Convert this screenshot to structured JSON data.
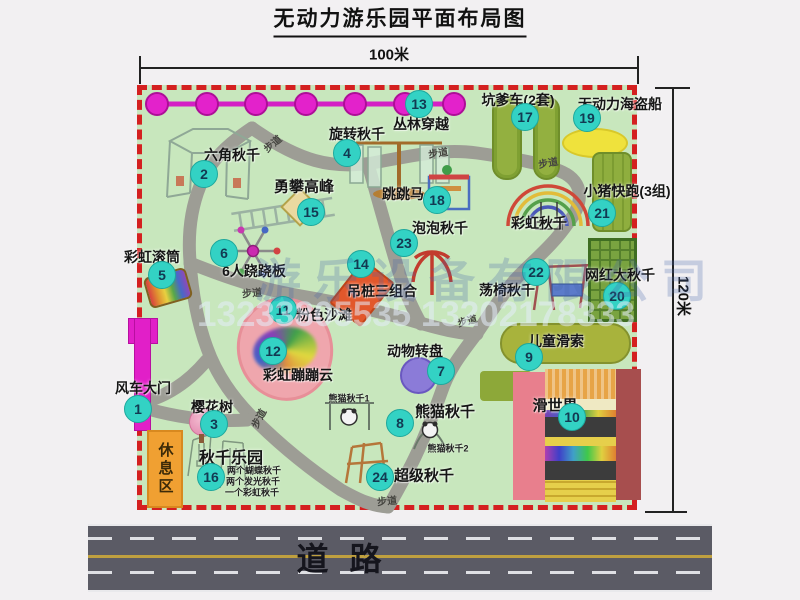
{
  "title": "无动力游乐园平面布局图",
  "dimensions": {
    "width": "100米",
    "height": "120米"
  },
  "watermark": {
    "company": "游乐设备有限公司",
    "phone": "13233805535 13202178333"
  },
  "road": {
    "label": "道  路"
  },
  "park": {
    "path_label": "步道",
    "rest_area_label": "休息区",
    "rainbow_swing_label": "彩虹秋千",
    "panda_swing_sub1": "熊猫秋千1",
    "panda_swing_sub2": "熊猫秋千2",
    "swing_park_details": [
      "两个蝴蝶秋千",
      "两个发光秋千",
      "一个彩虹秋千"
    ],
    "attractions": [
      {
        "num": "1",
        "name": "风车大门"
      },
      {
        "num": "2",
        "name": "六角秋千"
      },
      {
        "num": "3",
        "name": "樱花树"
      },
      {
        "num": "4",
        "name": "旋转秋千"
      },
      {
        "num": "5",
        "name": "彩虹滚筒"
      },
      {
        "num": "6",
        "name": "6人跷跷板"
      },
      {
        "num": "7",
        "name": "动物转盘"
      },
      {
        "num": "8",
        "name": "熊猫秋千"
      },
      {
        "num": "9",
        "name": "儿童滑索"
      },
      {
        "num": "10",
        "name": "滑世界"
      },
      {
        "num": "11",
        "name": "粉色沙滩"
      },
      {
        "num": "12",
        "name": "彩虹蹦蹦云"
      },
      {
        "num": "13",
        "name": "丛林穿越"
      },
      {
        "num": "14",
        "name": "吊桩三组合"
      },
      {
        "num": "15",
        "name": "勇攀高峰"
      },
      {
        "num": "16",
        "name": "秋千乐园"
      },
      {
        "num": "17",
        "name": "坑爹车(2套)"
      },
      {
        "num": "18",
        "name": "跳跳马"
      },
      {
        "num": "19",
        "name": "无动力海盗船"
      },
      {
        "num": "20",
        "name": "网红大秋千"
      },
      {
        "num": "21",
        "name": "小猪快跑(3组)"
      },
      {
        "num": "22",
        "name": "荡椅秋千"
      },
      {
        "num": "23",
        "name": "泡泡秋千"
      },
      {
        "num": "24",
        "name": "超级秋千"
      }
    ],
    "colors": {
      "park_green": "#c8e7bd",
      "border_red": "#d42020",
      "badge_teal": "#33d2c4",
      "chain_magenta": "#e322cb",
      "road_gray": "#5b5b65",
      "rest_orange": "#f0a032"
    }
  }
}
